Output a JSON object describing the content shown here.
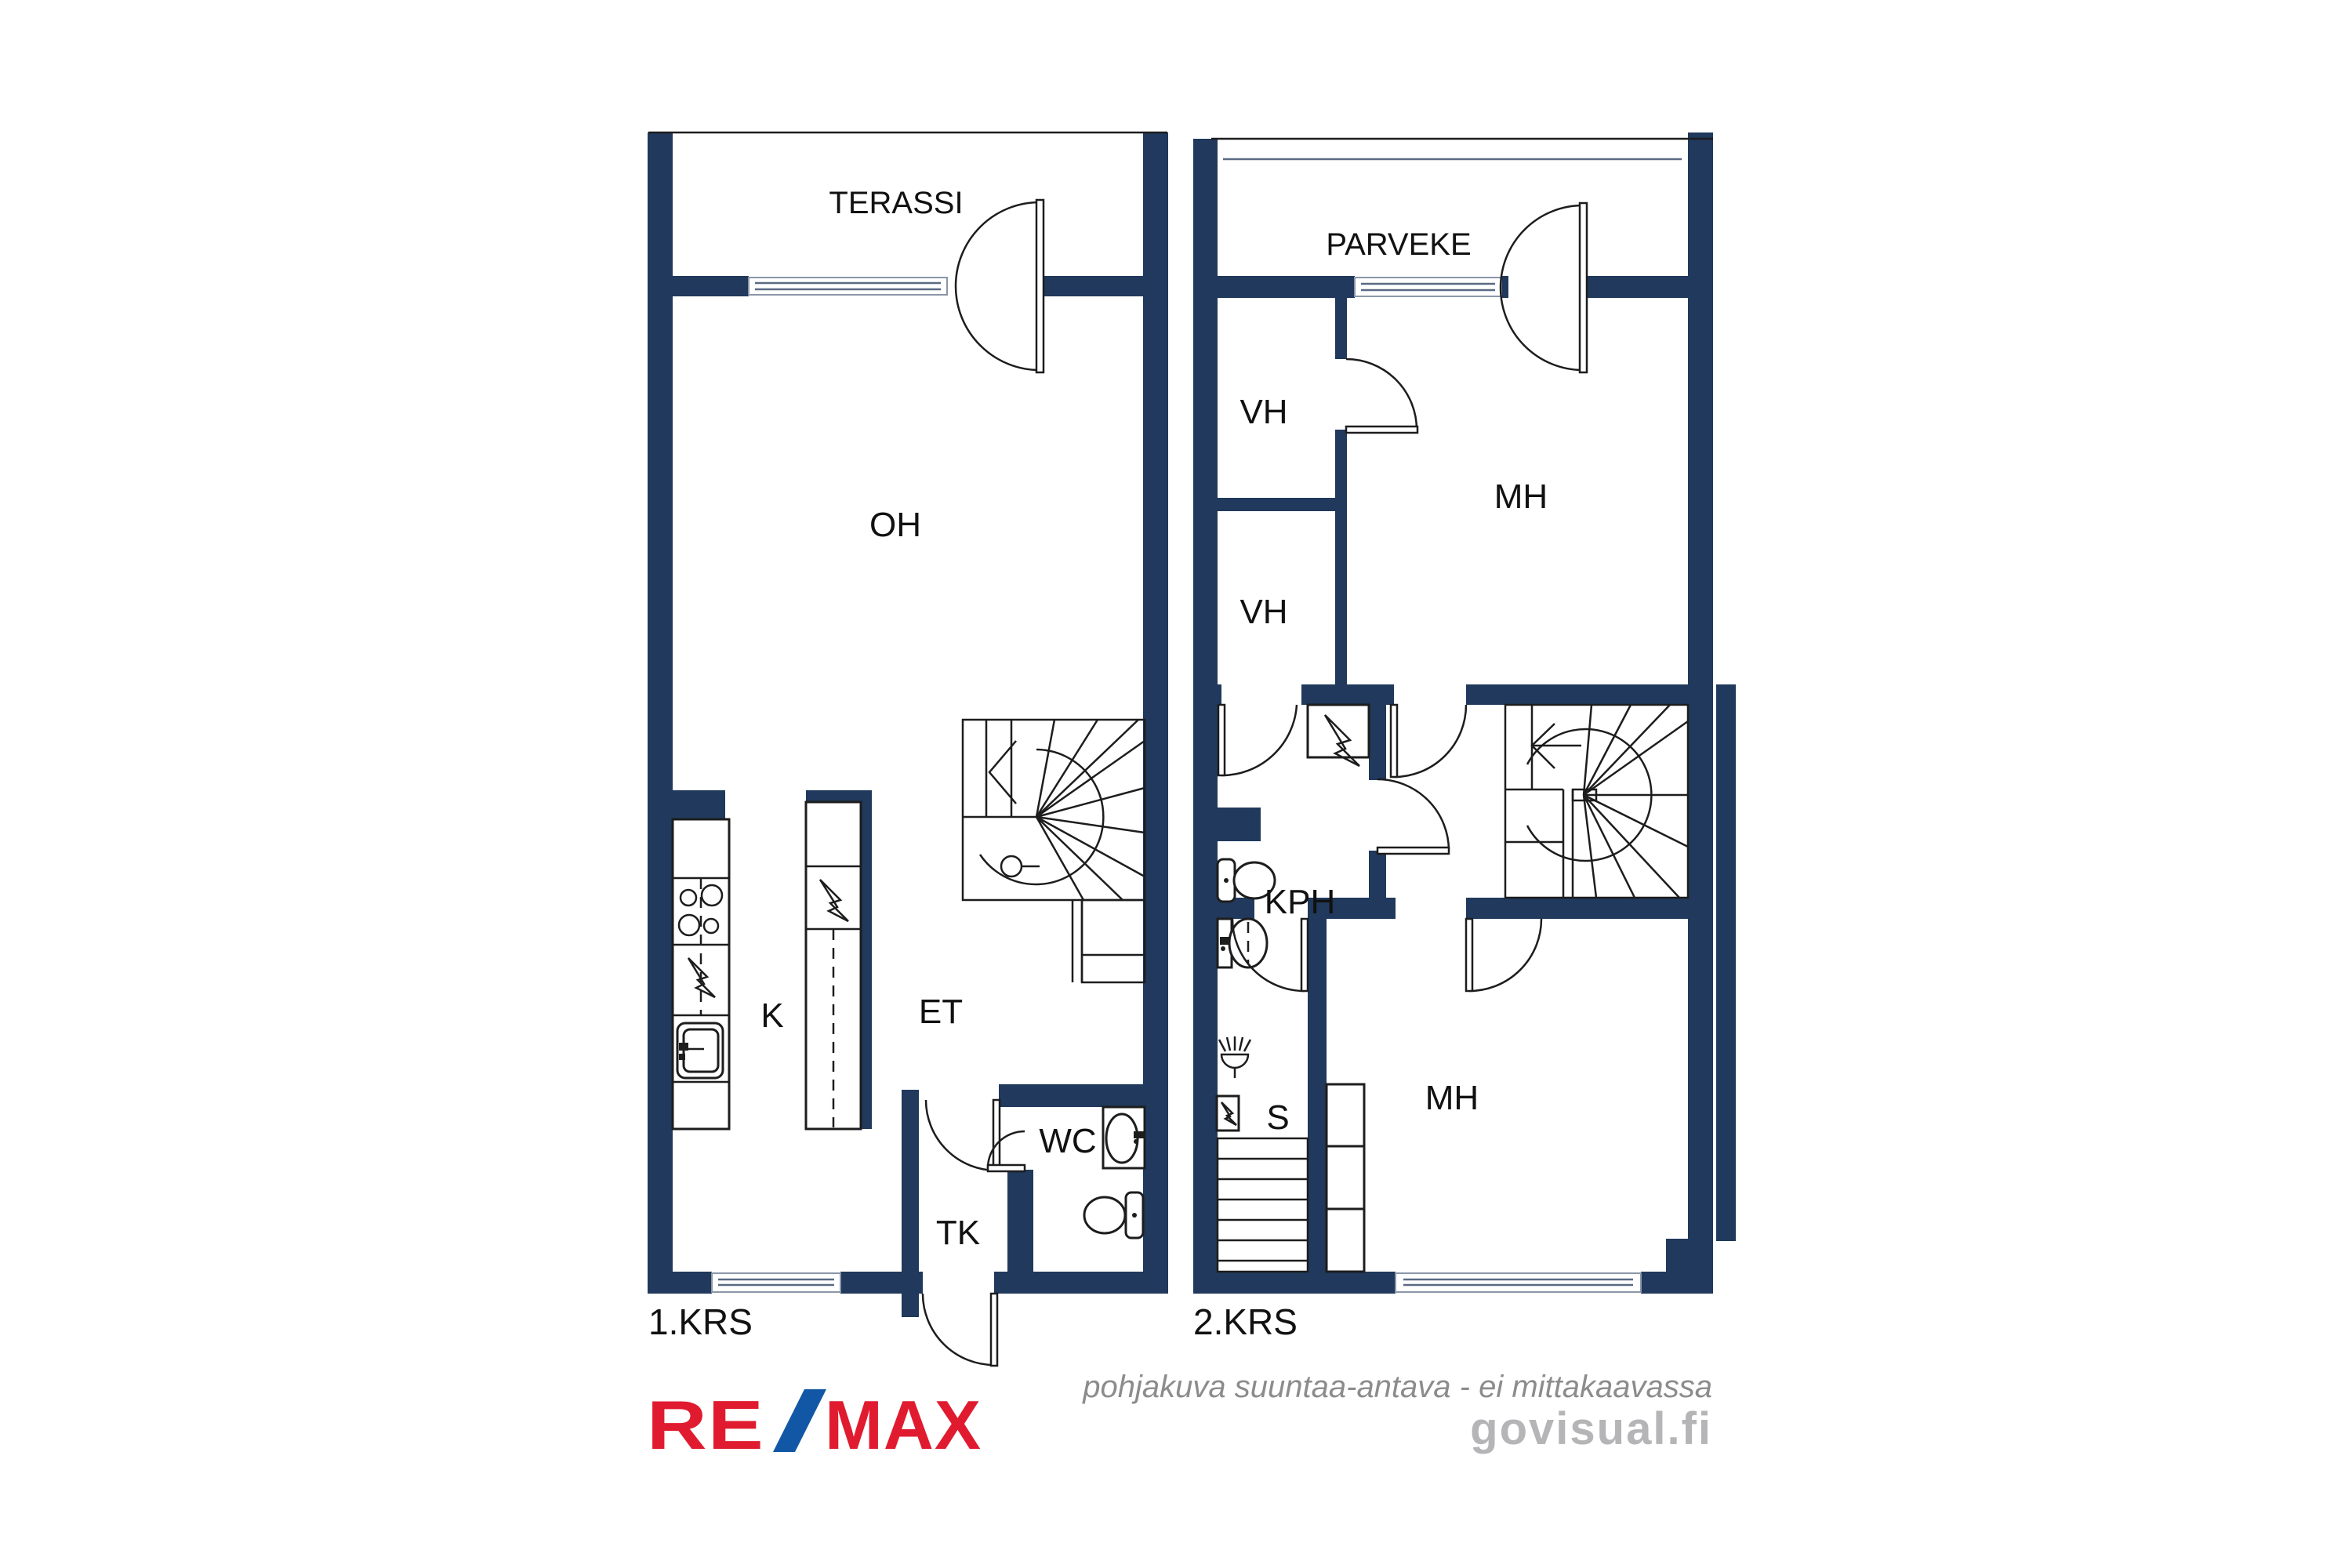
{
  "colors": {
    "wall_navy": "#20395c",
    "line_black": "#1d1d1d",
    "disclaimer_gray": "#8c8c8c",
    "watermark_gray": "#b5b5b8",
    "remax_red": "#e11b2f",
    "remax_blue": "#1257a5"
  },
  "floor1": {
    "label": "1.KRS",
    "rooms": {
      "terassi": "TERASSI",
      "oh": "OH",
      "k": "K",
      "et": "ET",
      "wc": "WC",
      "tk": "TK"
    }
  },
  "floor2": {
    "label": "2.KRS",
    "rooms": {
      "parveke": "PARVEKE",
      "vh1": "VH",
      "vh2": "VH",
      "mh1": "MH",
      "kph": "KPH",
      "s": "S",
      "mh2": "MH"
    }
  },
  "footer": {
    "disclaimer": "pohjakuva suuntaa-antava - ei mittakaavassa",
    "watermark": "govisual.fi",
    "brand_re": "RE",
    "brand_slash": "/",
    "brand_max": "MAX"
  }
}
